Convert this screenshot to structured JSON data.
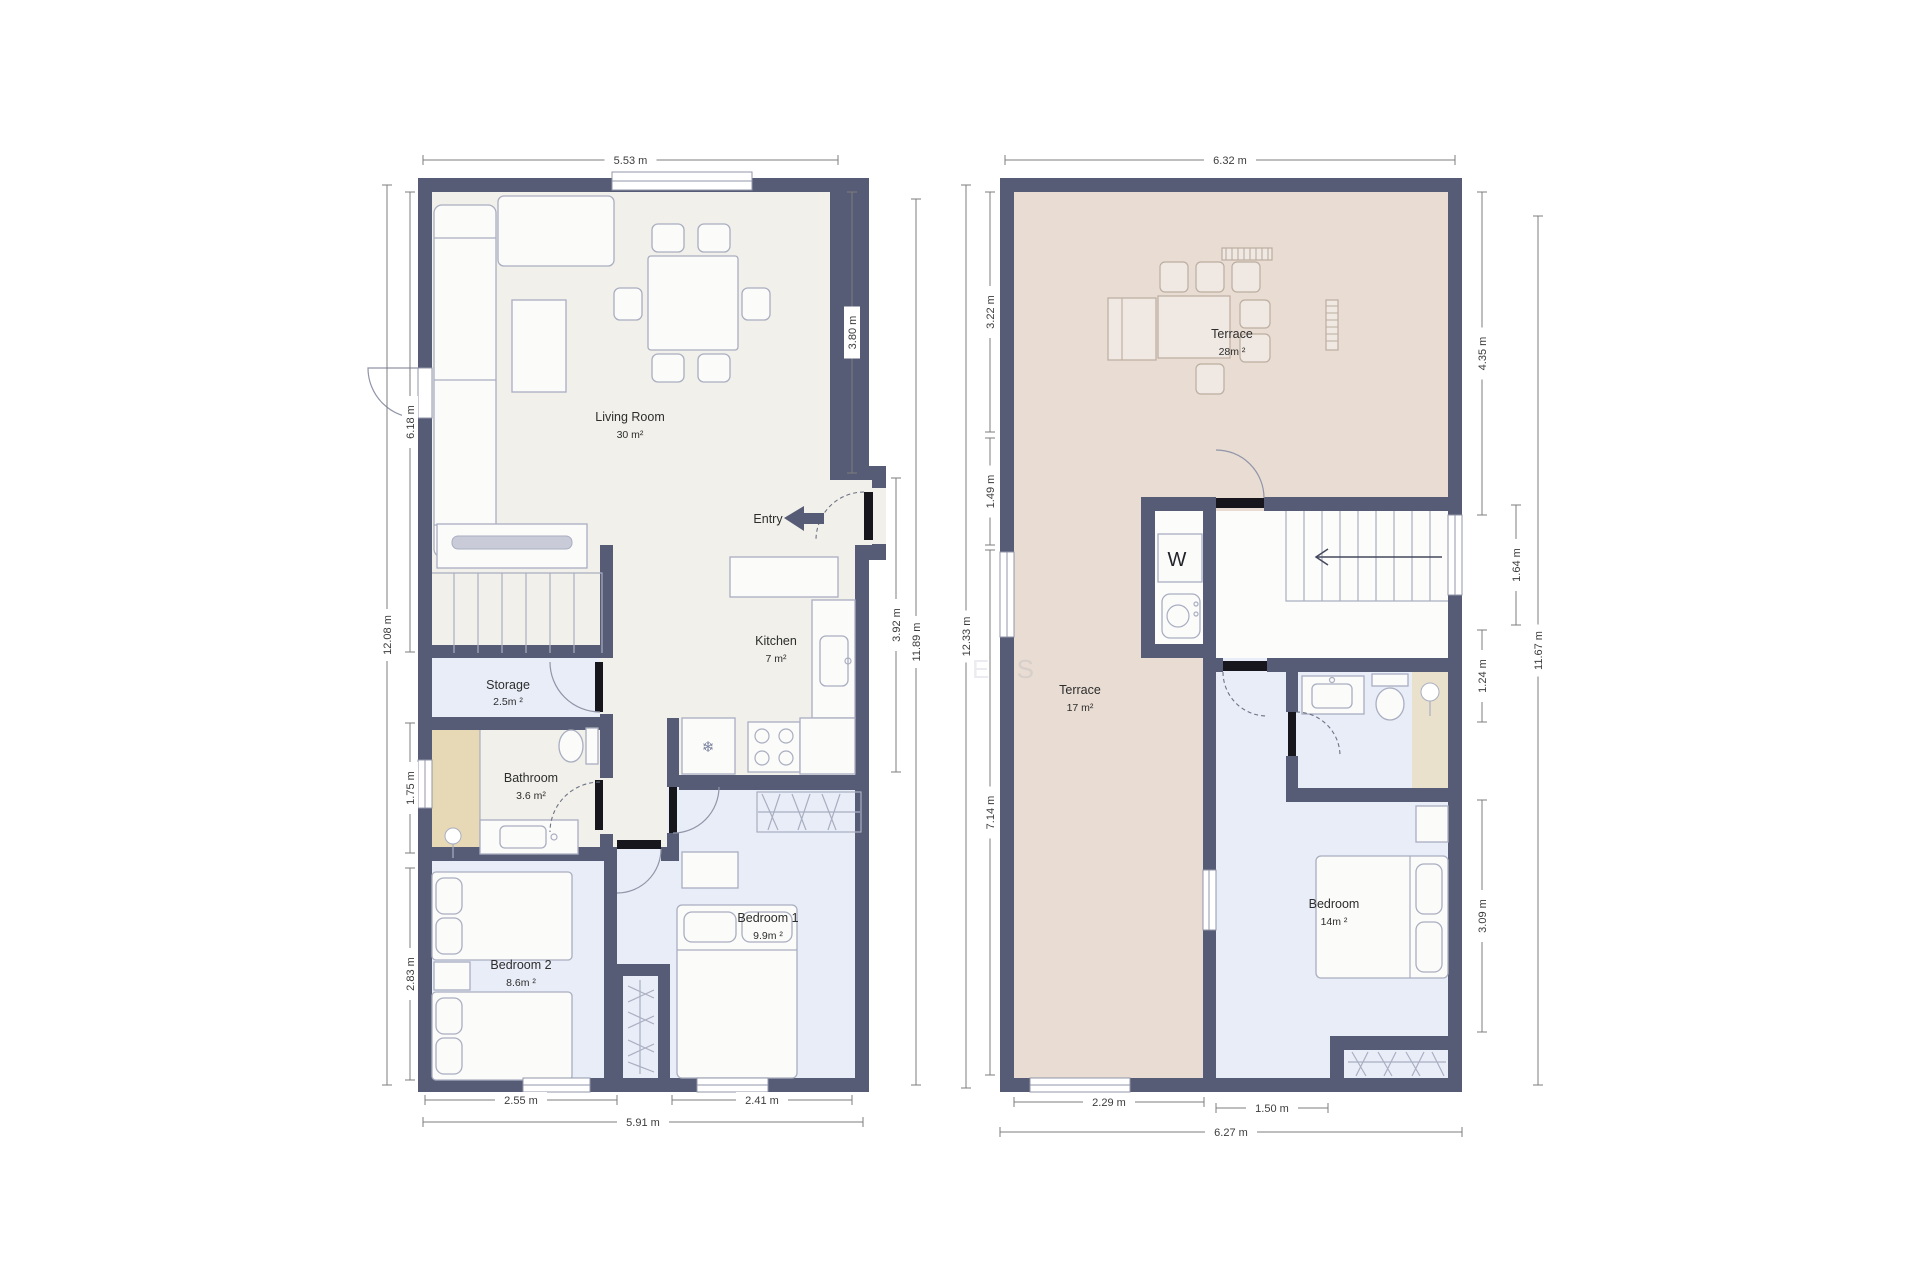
{
  "floor1": {
    "living_room": {
      "label": "Living Room",
      "area": "30 m²"
    },
    "kitchen": {
      "label": "Kitchen",
      "area": "7 m²"
    },
    "storage": {
      "label": "Storage",
      "area": "2.5m ²"
    },
    "bathroom": {
      "label": "Bathroom",
      "area": "3.6 m²"
    },
    "bedroom1": {
      "label": "Bedroom 1",
      "area": "9.9m ²"
    },
    "bedroom2": {
      "label": "Bedroom 2",
      "area": "8.6m ²"
    },
    "entry": {
      "label": "Entry"
    },
    "dimensions": {
      "top": "5.53 m",
      "left_outer": "12.08 m",
      "left_living": "6.18 m",
      "left_bath": "1.75 m",
      "left_bed2": "2.83 m",
      "right_living": "3.80 m",
      "right_kitchen": "3.92 m",
      "right_outer": "11.89 m",
      "bottom_bed2": "2.55 m",
      "bottom_bed1": "2.41 m",
      "bottom_outer": "5.91 m"
    }
  },
  "floor2": {
    "terrace_upper": {
      "label": "Terrace",
      "area": "28m ²"
    },
    "terrace_lower": {
      "label": "Terrace",
      "area": "17 m²"
    },
    "bedroom": {
      "label": "Bedroom",
      "area": "14m ²"
    },
    "washer_label": "W",
    "dimensions": {
      "top": "6.32 m",
      "left_upper": "3.22 m",
      "left_mid": "1.49 m",
      "left_lower": "7.14 m",
      "left_outer": "12.33 m",
      "right_terrace": "4.35 m",
      "right_stairs": "1.64 m",
      "right_outer": "11.67 m",
      "right_bath": "1.24 m",
      "right_bedroom": "3.09 m",
      "bottom_terrace": "2.29 m",
      "bottom_bedroom": "1.50 m",
      "bottom_outer": "6.27 m"
    }
  },
  "icons": {
    "fridge_snowflake": "❄"
  },
  "watermark": "E S"
}
